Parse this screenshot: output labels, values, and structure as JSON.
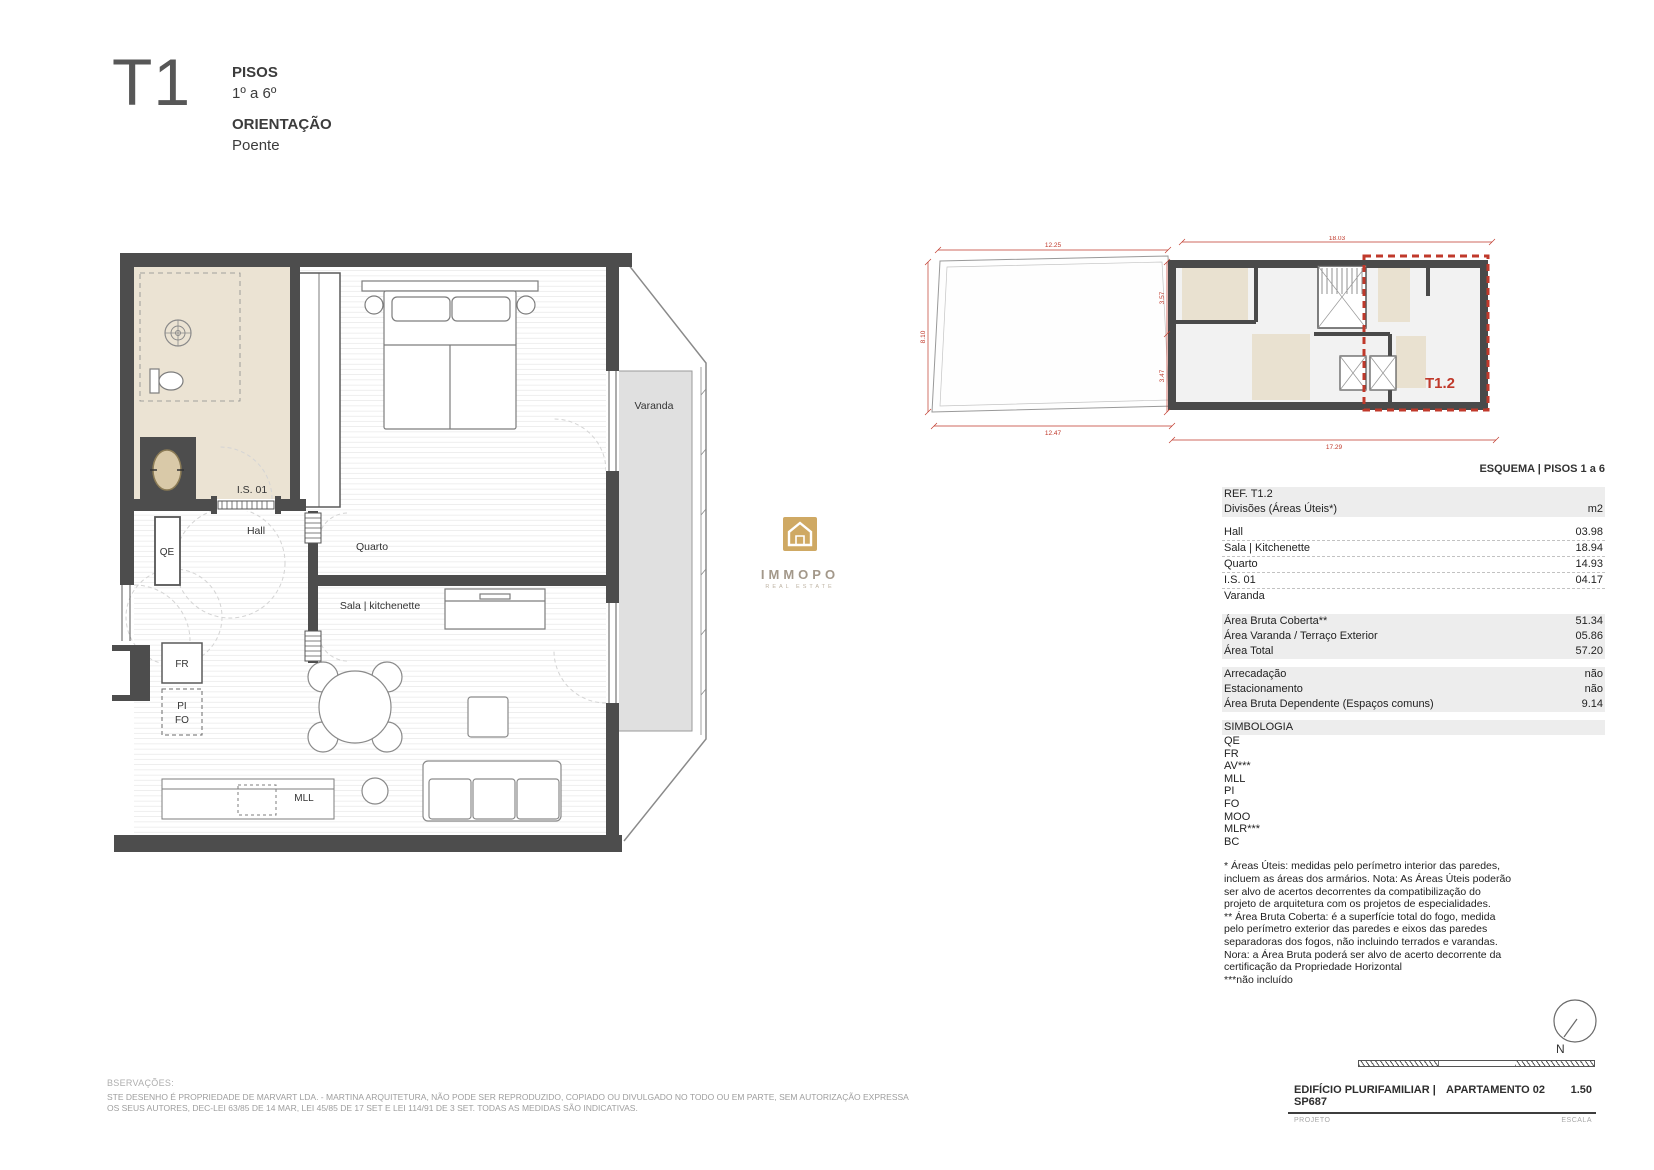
{
  "header": {
    "unit_type": "T1",
    "pisos_label": "PISOS",
    "pisos_value": "1º a 6º",
    "orientacao_label": "ORIENTAÇÃO",
    "orientacao_value": "Poente"
  },
  "plan": {
    "labels": {
      "is01": "I.S. 01",
      "hall": "Hall",
      "qe": "QE",
      "quarto": "Quarto",
      "sala": "Sala | kitchenette",
      "fr": "FR",
      "pi": "PI",
      "fo": "FO",
      "mll": "MLL",
      "varanda": "Varanda"
    }
  },
  "logo": {
    "title": "IMMOPO",
    "subtitle": "REAL ESTATE"
  },
  "schema": {
    "caption": "ESQUEMA | PISOS 1 a 6",
    "unit_label": "T1.2",
    "dims": {
      "top_left": "12.25",
      "top_right": "18.03",
      "left": "8.10",
      "mid_upper": "3.57",
      "mid_lower": "3.47",
      "bottom_left": "12.47",
      "bottom": "17.29"
    }
  },
  "table": {
    "ref": "REF. T1.2",
    "divisions_header": "Divisões (Áreas Úteis*)",
    "unit_header": "m2",
    "rooms": [
      {
        "label": "Hall",
        "value": "03.98"
      },
      {
        "label": "Sala | Kitchenette",
        "value": "18.94"
      },
      {
        "label": "Quarto",
        "value": "14.93"
      },
      {
        "label": "I.S. 01",
        "value": "04.17"
      },
      {
        "label": "Varanda",
        "value": ""
      }
    ],
    "areas": [
      {
        "label": "Área Bruta Coberta**",
        "value": "51.34"
      },
      {
        "label": "Área Varanda / Terraço Exterior",
        "value": "05.86"
      },
      {
        "label": "Área Total",
        "value": "57.20"
      }
    ],
    "extras": [
      {
        "label": "Arrecadação",
        "value": "não"
      },
      {
        "label": "Estacionamento",
        "value": "não"
      },
      {
        "label": "Área Bruta Dependente (Espaços comuns)",
        "value": "9.14"
      }
    ],
    "simbologia_title": "SIMBOLOGIA",
    "simbologia_items": [
      "QE",
      "FR",
      "AV***",
      "MLL",
      "PI",
      "FO",
      "MOO",
      "MLR***",
      "BC"
    ],
    "footnote": "* Áreas Úteis: medidas pelo perímetro interior das paredes,\nincluem as áreas dos armários. Nota: As Áreas Úteis poderão\nser alvo de acertos decorrentes da compatibilização do\nprojeto de arquitetura com os projetos de especialidades.\n** Área Bruta Coberta: é a superfície total do fogo, medida\npelo perímetro exterior das paredes e eixos das paredes\nseparadoras dos fogos, não incluindo terrados e varandas.\nNora: a Área Bruta poderá ser alvo de acerto decorrente da\ncertificação da Propriedade Horizontal\n***não incluído"
  },
  "titleblock": {
    "project": "EDIFÍCIO PLURIFAMILIAR | SP687",
    "apartment": "APARTAMENTO 02",
    "scale_value": "1.50",
    "project_label": "PROJETO",
    "scale_label": "ESCALA",
    "north_label": "N"
  },
  "footer": {
    "observacoes": "BSERVAÇÕES:",
    "line1": "STE DESENHO É PROPRIEDADE DE MARVART LDA. - MARTINA ARQUITETURA, NÃO PODE SER REPRODUZIDO, COPIADO OU DIVULGADO NO TODO OU EM PARTE, SEM AUTORIZAÇÃO EXPRESSA",
    "line2": "OS SEUS AUTORES, DEC-LEI 63/85 DE 14 MAR, LEI 45/85 DE 17 SET E LEI 114/91 DE 3 SET. TODAS AS MEDIDAS SÃO INDICATIVAS."
  },
  "colors": {
    "wall": "#4d4d4d",
    "highlight_red": "#c0392b",
    "band_gray": "#ededed",
    "bathroom_beige": "#ebe3d3",
    "logo_gold": "#cfa964"
  }
}
